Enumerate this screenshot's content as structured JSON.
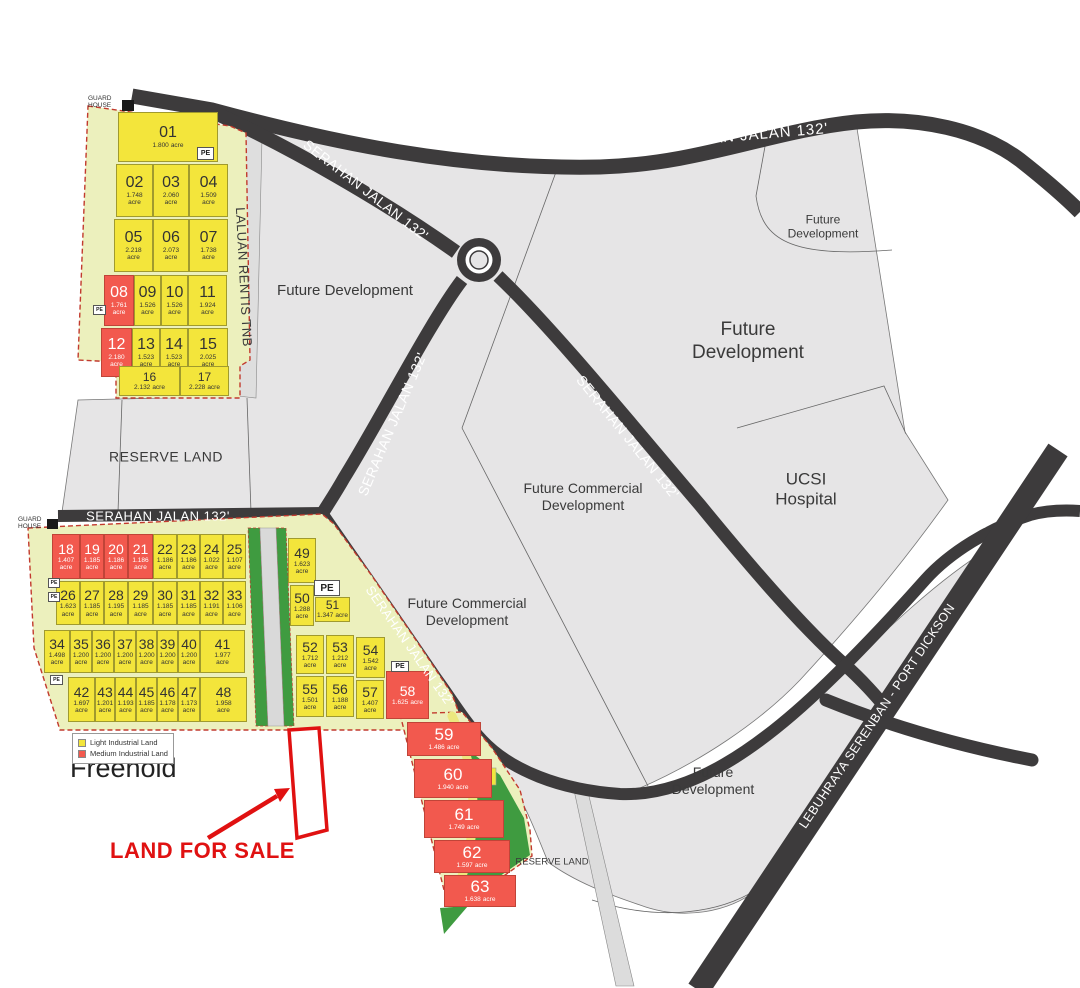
{
  "title": "Industrial land site plan",
  "roads": {
    "serahan": "SERAHAN JALAN 132'",
    "laluan_rentis": "LALUAN RENTIS TNB",
    "to_kl": "TO KL",
    "lebuhraya": "LEBUHRAYA SERENBAN - PORT DICKSON"
  },
  "labels": {
    "future_development": "Future Development",
    "future_commercial": "Future Commercial Development",
    "ucsi": "UCSI Hospital",
    "reserve_land": "RESERVE LAND",
    "freehold": "Freehold",
    "land_for_sale": "LAND FOR SALE",
    "guard_house": "GUARD HOUSE",
    "pe": "PE",
    "acre": "acre"
  },
  "legend": {
    "light": "Light Industrial Land",
    "medium": "Medium Industrial Land"
  },
  "colors": {
    "light_lot": "#f3e53b",
    "medium_lot": "#f2594e",
    "road": "#3d3b3c",
    "area_gray": "#e6e5e6",
    "green_reserve": "#3f9b40",
    "highlight_red": "#e01111",
    "cluster_bg": "#ecf0bd"
  },
  "lots": [
    {
      "n": "01",
      "a": "1.800",
      "t": "light"
    },
    {
      "n": "02",
      "a": "1.748",
      "t": "light"
    },
    {
      "n": "03",
      "a": "2.060",
      "t": "light"
    },
    {
      "n": "04",
      "a": "1.509",
      "t": "light"
    },
    {
      "n": "05",
      "a": "2.218",
      "t": "light"
    },
    {
      "n": "06",
      "a": "2.073",
      "t": "light"
    },
    {
      "n": "07",
      "a": "1.738",
      "t": "light"
    },
    {
      "n": "08",
      "a": "1.761",
      "t": "medium"
    },
    {
      "n": "09",
      "a": "1.526",
      "t": "light"
    },
    {
      "n": "10",
      "a": "1.526",
      "t": "light"
    },
    {
      "n": "11",
      "a": "1.924",
      "t": "light"
    },
    {
      "n": "12",
      "a": "2.180",
      "t": "medium"
    },
    {
      "n": "13",
      "a": "1.523",
      "t": "light"
    },
    {
      "n": "14",
      "a": "1.523",
      "t": "light"
    },
    {
      "n": "15",
      "a": "2.025",
      "t": "light"
    },
    {
      "n": "16",
      "a": "2.132",
      "t": "light"
    },
    {
      "n": "17",
      "a": "2.228",
      "t": "light"
    },
    {
      "n": "18",
      "a": "1.407",
      "t": "medium"
    },
    {
      "n": "19",
      "a": "1.185",
      "t": "medium"
    },
    {
      "n": "20",
      "a": "1.186",
      "t": "medium"
    },
    {
      "n": "21",
      "a": "1.186",
      "t": "medium"
    },
    {
      "n": "22",
      "a": "1.186",
      "t": "light"
    },
    {
      "n": "23",
      "a": "1.186",
      "t": "light"
    },
    {
      "n": "24",
      "a": "1.022",
      "t": "light"
    },
    {
      "n": "25",
      "a": "1.107",
      "t": "light"
    },
    {
      "n": "26",
      "a": "1.623",
      "t": "light"
    },
    {
      "n": "27",
      "a": "1.185",
      "t": "light"
    },
    {
      "n": "28",
      "a": "1.195",
      "t": "light"
    },
    {
      "n": "29",
      "a": "1.185",
      "t": "light"
    },
    {
      "n": "30",
      "a": "1.185",
      "t": "light"
    },
    {
      "n": "31",
      "a": "1.185",
      "t": "light"
    },
    {
      "n": "32",
      "a": "1.191",
      "t": "light"
    },
    {
      "n": "33",
      "a": "1.106",
      "t": "light"
    },
    {
      "n": "34",
      "a": "1.498",
      "t": "light"
    },
    {
      "n": "35",
      "a": "1.200",
      "t": "light"
    },
    {
      "n": "36",
      "a": "1.200",
      "t": "light"
    },
    {
      "n": "37",
      "a": "1.200",
      "t": "light"
    },
    {
      "n": "38",
      "a": "1.200",
      "t": "light"
    },
    {
      "n": "39",
      "a": "1.200",
      "t": "light"
    },
    {
      "n": "40",
      "a": "1.200",
      "t": "light"
    },
    {
      "n": "41",
      "a": "1.977",
      "t": "light"
    },
    {
      "n": "42",
      "a": "1.697",
      "t": "light"
    },
    {
      "n": "43",
      "a": "1.201",
      "t": "light"
    },
    {
      "n": "44",
      "a": "1.193",
      "t": "light"
    },
    {
      "n": "45",
      "a": "1.185",
      "t": "light"
    },
    {
      "n": "46",
      "a": "1.178",
      "t": "light"
    },
    {
      "n": "47",
      "a": "1.173",
      "t": "light"
    },
    {
      "n": "48",
      "a": "1.958",
      "t": "light"
    },
    {
      "n": "49",
      "a": "1.623",
      "t": "light"
    },
    {
      "n": "50",
      "a": "1.288",
      "t": "light"
    },
    {
      "n": "51",
      "a": "1.347",
      "t": "light"
    },
    {
      "n": "52",
      "a": "1.712",
      "t": "light"
    },
    {
      "n": "53",
      "a": "1.212",
      "t": "light"
    },
    {
      "n": "54",
      "a": "1.542",
      "t": "light"
    },
    {
      "n": "55",
      "a": "1.501",
      "t": "light"
    },
    {
      "n": "56",
      "a": "1.188",
      "t": "light"
    },
    {
      "n": "57",
      "a": "1.407",
      "t": "light"
    },
    {
      "n": "58",
      "a": "1.625",
      "t": "medium"
    },
    {
      "n": "59",
      "a": "1.486",
      "t": "medium"
    },
    {
      "n": "60",
      "a": "1.940",
      "t": "medium"
    },
    {
      "n": "61",
      "a": "1.749",
      "t": "medium"
    },
    {
      "n": "62",
      "a": "1.597",
      "t": "medium"
    },
    {
      "n": "63",
      "a": "1.638",
      "t": "medium"
    }
  ]
}
